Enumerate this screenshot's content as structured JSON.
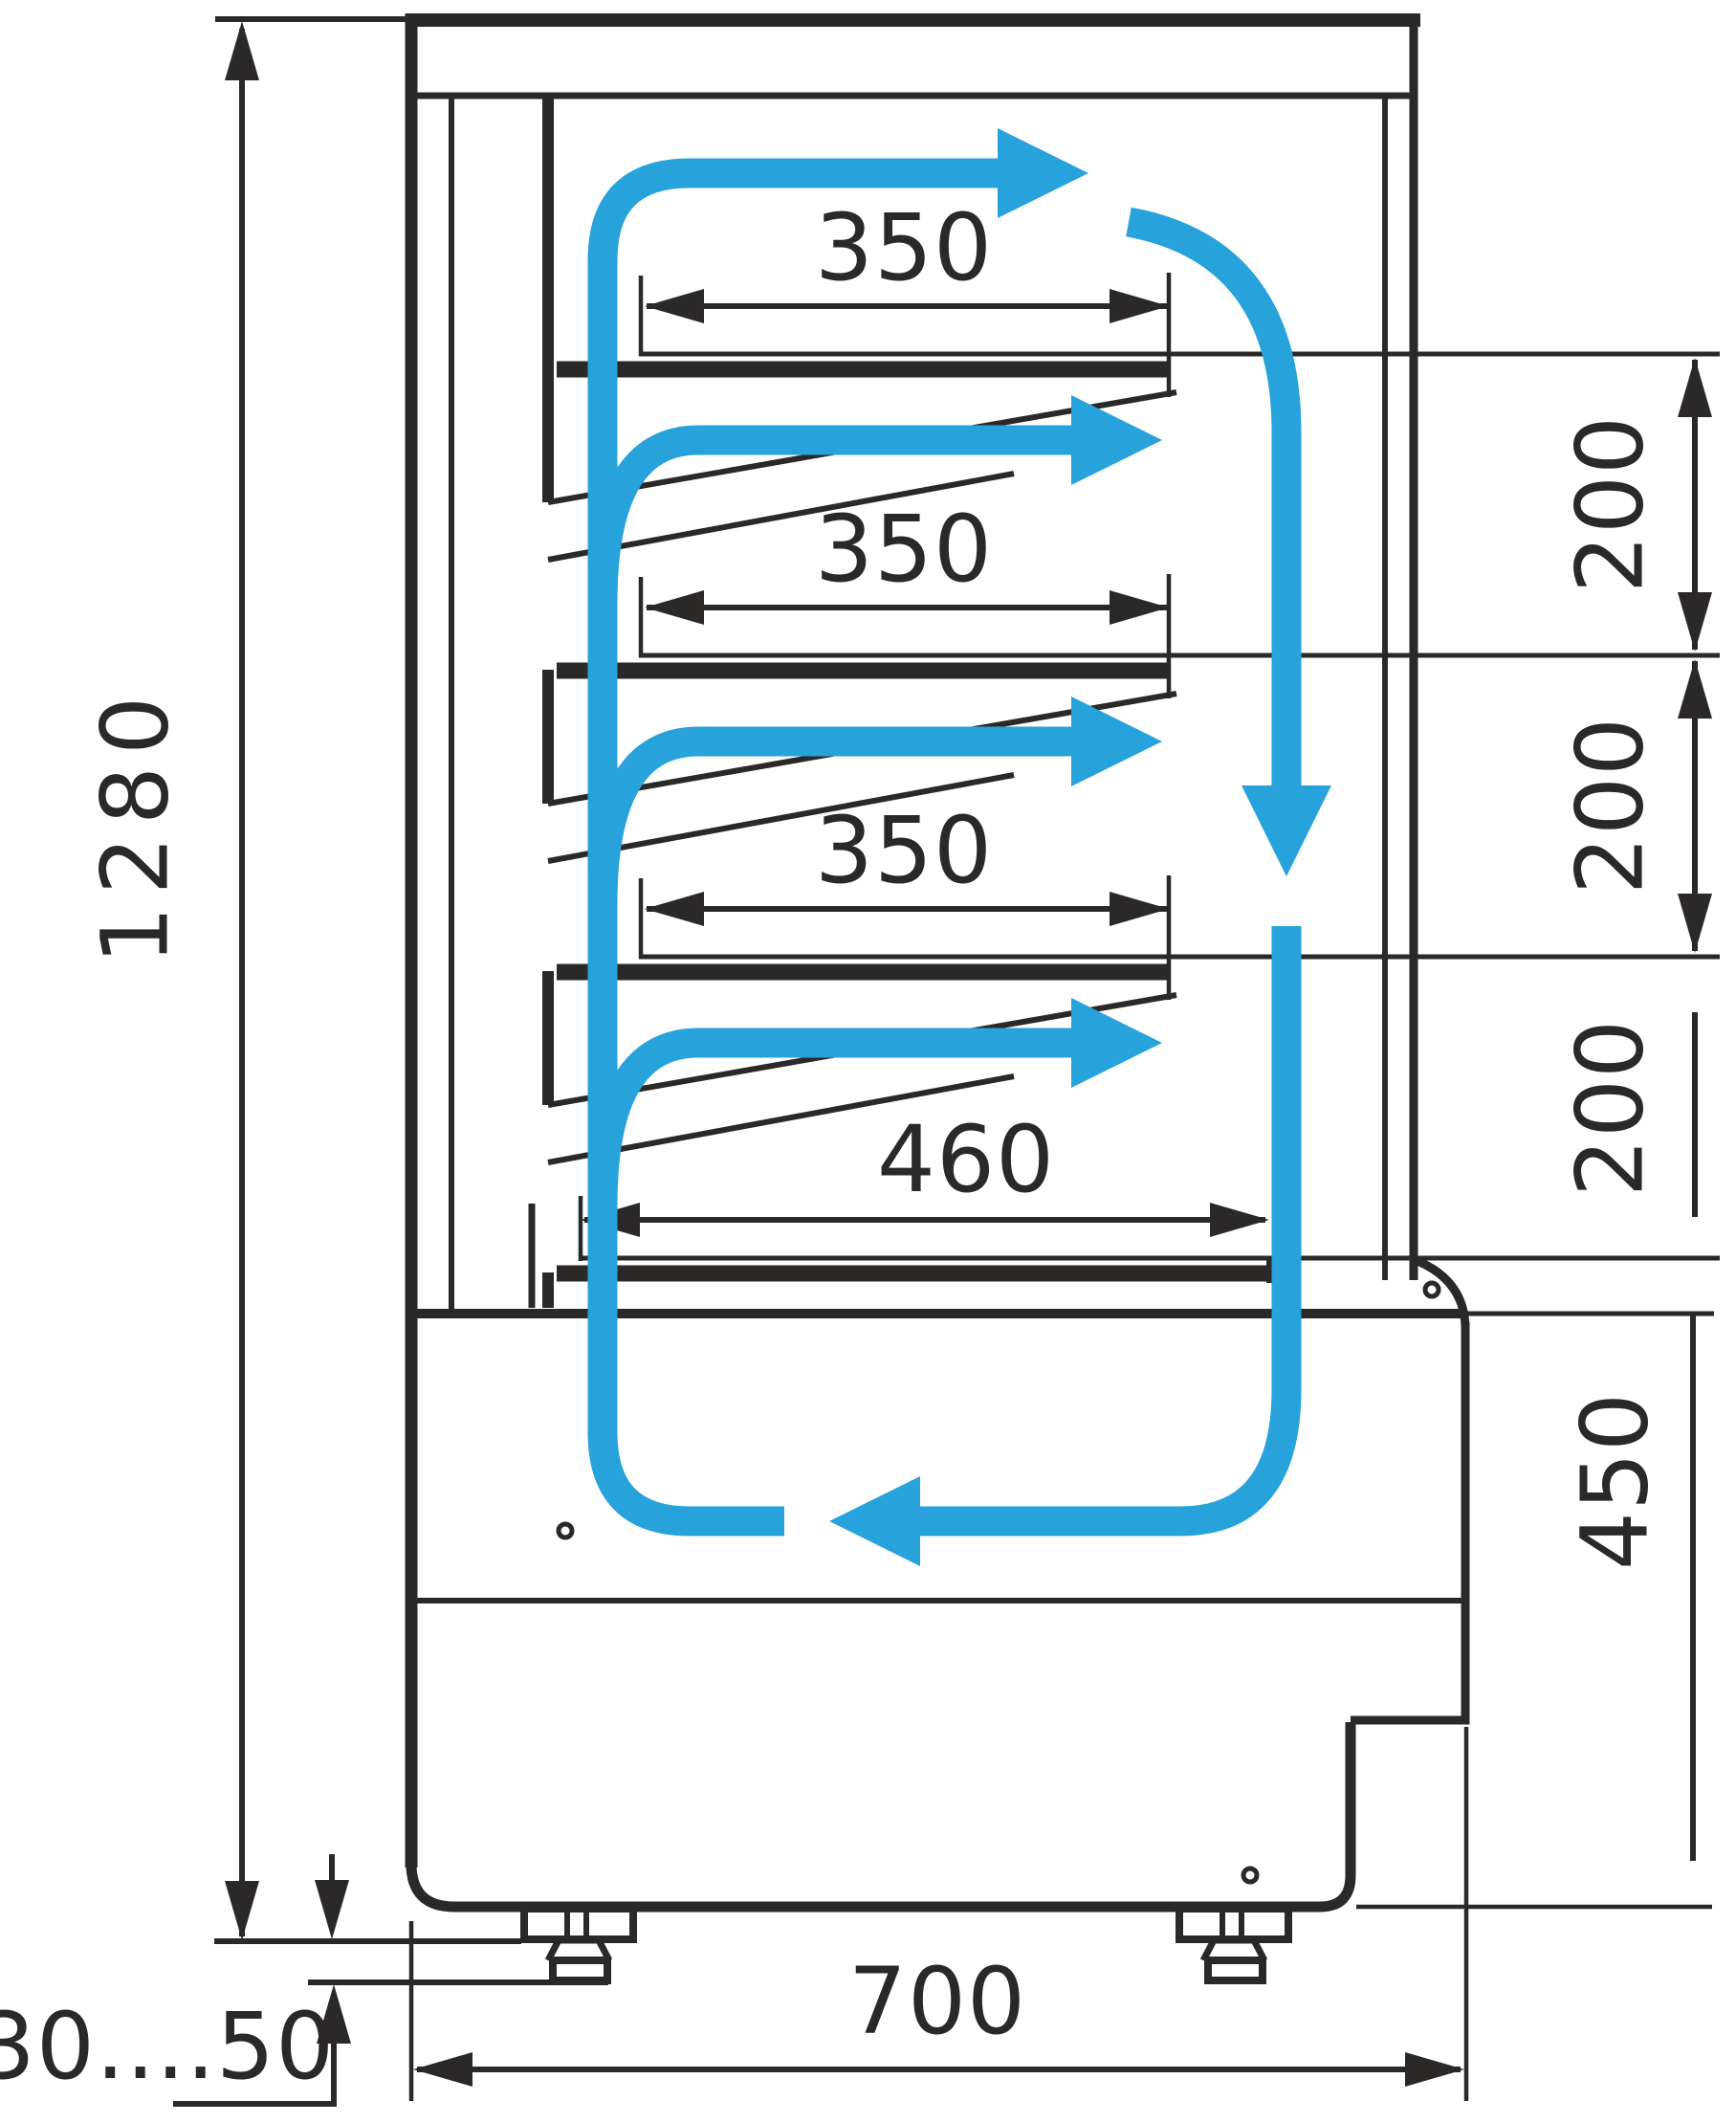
{
  "diagram": {
    "type": "technical-drawing",
    "subject": "Refrigerated display case side cross-section with air circulation arrows",
    "units": "mm",
    "colors": {
      "line": "#2b2828",
      "airflow": "#27a2db",
      "background": "#ffffff"
    },
    "dimensions": {
      "total_height": "1280",
      "shelf_depth_top": "350",
      "shelf_depth_middle": "350",
      "shelf_depth_lower": "350",
      "base_shelf_depth": "460",
      "gap_shelf_1_2": "200",
      "gap_shelf_2_3": "200",
      "gap_shelf_3_base": "200",
      "base_section_height": "450",
      "overall_depth": "700",
      "leg_height_range": "30....50"
    }
  }
}
